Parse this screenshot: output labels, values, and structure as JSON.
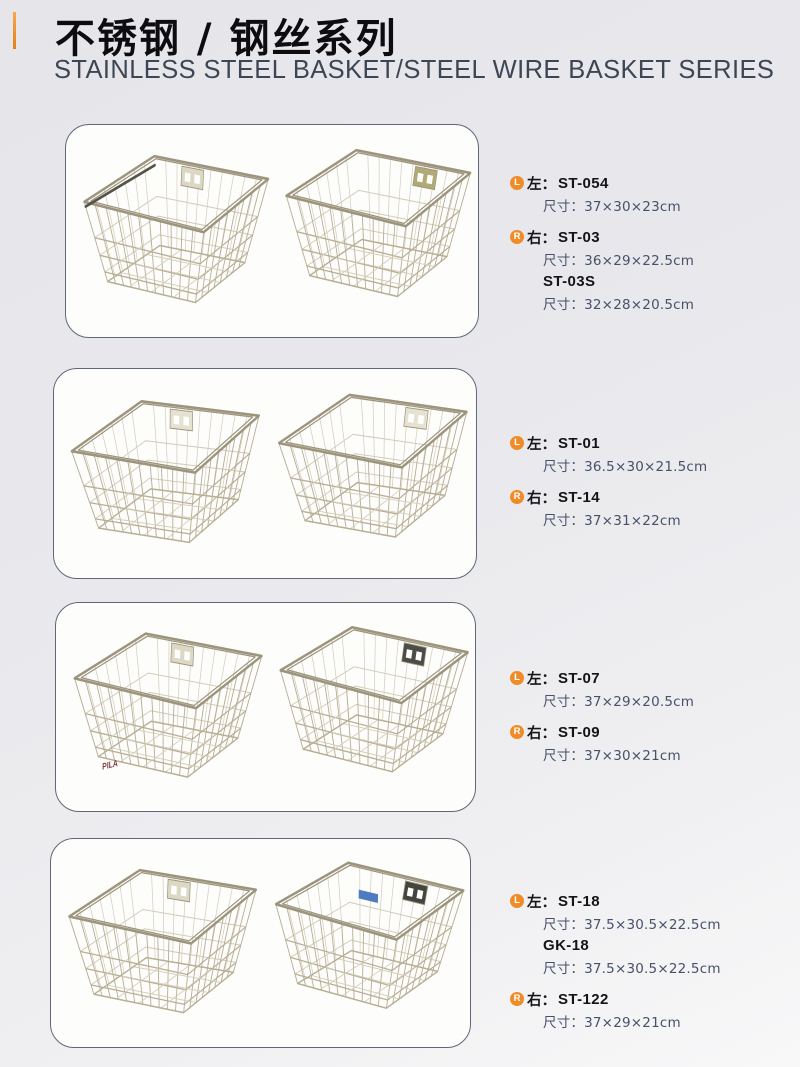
{
  "header": {
    "accent_color": "#ef8c28",
    "title_cn": "不锈钢 / 钢丝系列",
    "title_en": "STAINLESS STEEL BASKET/STEEL WIRE BASKET SERIES"
  },
  "products": [
    {
      "left": {
        "badge": "L",
        "side": "左：",
        "models": [
          {
            "name": "ST-054",
            "size": "尺寸：37×30×23cm"
          }
        ]
      },
      "right": {
        "badge": "R",
        "side": "右：",
        "models": [
          {
            "name": "ST-03",
            "size": "尺寸：36×29×22.5cm"
          },
          {
            "name": "ST-03S",
            "size": "尺寸：32×28×20.5cm"
          }
        ]
      }
    },
    {
      "left": {
        "badge": "L",
        "side": "左：",
        "models": [
          {
            "name": "ST-01",
            "size": "尺寸：36.5×30×21.5cm"
          }
        ]
      },
      "right": {
        "badge": "R",
        "side": "右：",
        "models": [
          {
            "name": "ST-14",
            "size": "尺寸：37×31×22cm"
          }
        ]
      }
    },
    {
      "left": {
        "badge": "L",
        "side": "左：",
        "watermark": "PILA",
        "models": [
          {
            "name": "ST-07",
            "size": "尺寸：37×29×20.5cm"
          }
        ]
      },
      "right": {
        "badge": "R",
        "side": "右：",
        "models": [
          {
            "name": "ST-09",
            "size": "尺寸：37×30×21cm"
          }
        ]
      }
    },
    {
      "left": {
        "badge": "L",
        "side": "左：",
        "models": [
          {
            "name": "ST-18",
            "size": "尺寸：37.5×30.5×22.5cm"
          },
          {
            "name": "GK-18",
            "size": "尺寸：37.5×30.5×22.5cm"
          }
        ]
      },
      "right": {
        "badge": "R",
        "side": "右：",
        "models": [
          {
            "name": "ST-122",
            "size": "尺寸：37×29×21cm"
          }
        ]
      }
    }
  ]
}
